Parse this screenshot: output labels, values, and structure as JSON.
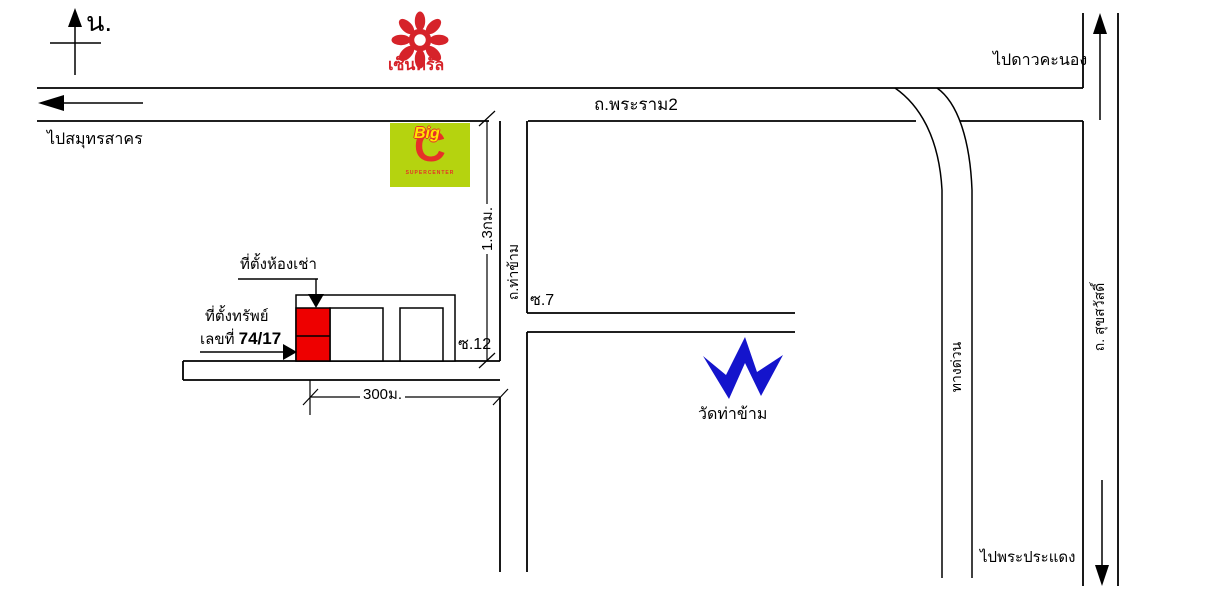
{
  "map": {
    "compass": {
      "north_label": "น."
    },
    "roads": {
      "rama2": {
        "label": "ถ.พระราม2",
        "dir_west": "ไปสมุทรสาคร",
        "dir_east": "ไปดาวคะนอง"
      },
      "thakham": {
        "label": "ถ.ท่าข้าม"
      },
      "suksawat": {
        "label": "ถ. สุขสวัสดิ์",
        "dir_south": "ไปพระประแดง"
      },
      "expressway": {
        "label": "ทางด่วน"
      },
      "soi7": {
        "label": "ซ.7"
      },
      "soi12": {
        "label": "ซ.12"
      }
    },
    "landmarks": {
      "central": {
        "name": "เซ็นทรัล"
      },
      "bigc": {
        "word_big": "Big",
        "letter_c": "C",
        "tagline": "SUPERCENTER"
      },
      "temple": {
        "name": "วัดท่าข้าม"
      }
    },
    "property": {
      "rental_label": "ที่ตั้งห้องเช่า",
      "prop_label_line1": "ที่ตั้งทรัพย์",
      "prop_label_line2_prefix": "เลขที่",
      "prop_number": "74/17"
    },
    "dimensions": {
      "to_soi12": "1.3กม.",
      "soi_length": "300ม."
    }
  },
  "colors": {
    "line": "#000000",
    "background": "#ffffff",
    "central_red": "#d6232a",
    "bigc_green": "#b5d30f",
    "bigc_red": "#e63128",
    "bigc_yellow": "#ffe400",
    "property_red": "#ee0000",
    "temple_blue": "#1414cc"
  }
}
